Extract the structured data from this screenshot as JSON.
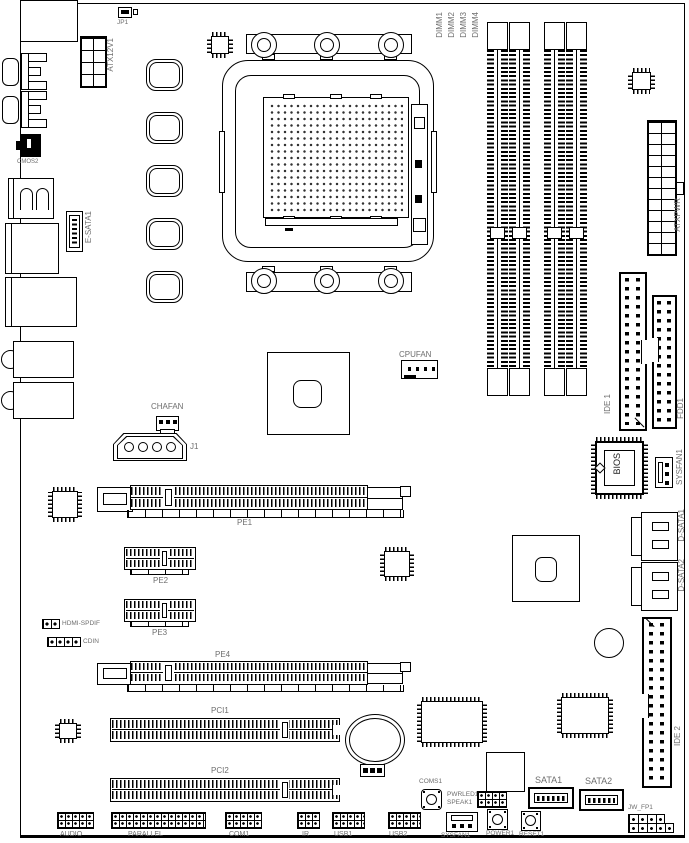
{
  "colors": {
    "line": "#000000",
    "label": "#6e6e6e",
    "background": "#ffffff"
  },
  "labels": {
    "jp1": "JP1",
    "atx12v1": "ATX12V1",
    "cmos2": "CMOS2",
    "esata1": "E-SATA1",
    "dimm1": "DIMM1",
    "dimm2": "DIMM2",
    "dimm3": "DIMM3",
    "dimm4": "DIMM4",
    "atxpwr": "ATXPWR",
    "cpufan": "CPUFAN",
    "chafan": "CHAFAN",
    "j1": "J1",
    "ide1": "IDE 1",
    "fdd1": "FDD1",
    "bios": "BIOS",
    "sysfan1_right": "SYSFAN1",
    "dsata1": "D-SATA1",
    "dsata2": "D-SATA2",
    "pe1": "PE1",
    "pe2": "PE2",
    "pe3": "PE3",
    "pe4": "PE4",
    "hdmi_spdif": "HDMI-SPDIF",
    "cdin": "CDIN",
    "pci1": "PCI1",
    "pci2": "PCI2",
    "ide2": "IDE 2",
    "jw_fp1": "JW_FP1",
    "audio": "AUDIO",
    "parallel": "PARALLEL",
    "com1": "COM1",
    "ir": "IR",
    "usb1": "USB1",
    "usb2": "USB2",
    "coms1": "COMS1",
    "sysfan1_bottom": "SYSFAN1",
    "pwrled1": "PWRLED1",
    "speak1": "SPEAK1",
    "power1": "POWER1",
    "reset1": "RESET1",
    "sata1": "SATA1",
    "sata2": "SATA2"
  }
}
